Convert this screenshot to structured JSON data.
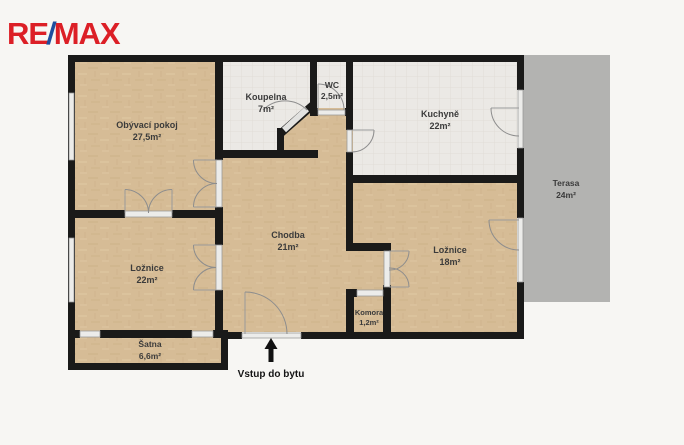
{
  "logo": {
    "re": "RE",
    "slash": "/",
    "max": "MAX"
  },
  "rooms": {
    "obyvaci": {
      "name": "Obývací pokoj",
      "area": "27,5m²"
    },
    "koupelna": {
      "name": "Koupelna",
      "area": "7m²"
    },
    "wc": {
      "name": "WC",
      "area": "2,5m²"
    },
    "kuchyne": {
      "name": "Kuchyně",
      "area": "22m²"
    },
    "terasa": {
      "name": "Terasa",
      "area": "24m²"
    },
    "chodba": {
      "name": "Chodba",
      "area": "21m²"
    },
    "loznice22": {
      "name": "Ložnice",
      "area": "22m²"
    },
    "loznice18": {
      "name": "Ložnice",
      "area": "18m²"
    },
    "komora": {
      "name": "Komora",
      "area": "1,2m²"
    },
    "satna": {
      "name": "Šatna",
      "area": "6,6m²"
    }
  },
  "entrance": {
    "label": "Vstup do bytu"
  },
  "colors": {
    "wall": "#1a1a19",
    "floor_wood": "#d6bc96",
    "floor_tile": "#ebe9e5",
    "terrace": "#b3b3b1",
    "background": "#f7f6f3",
    "logo_red": "#dc1f26",
    "logo_blue": "#1e4e9e"
  }
}
